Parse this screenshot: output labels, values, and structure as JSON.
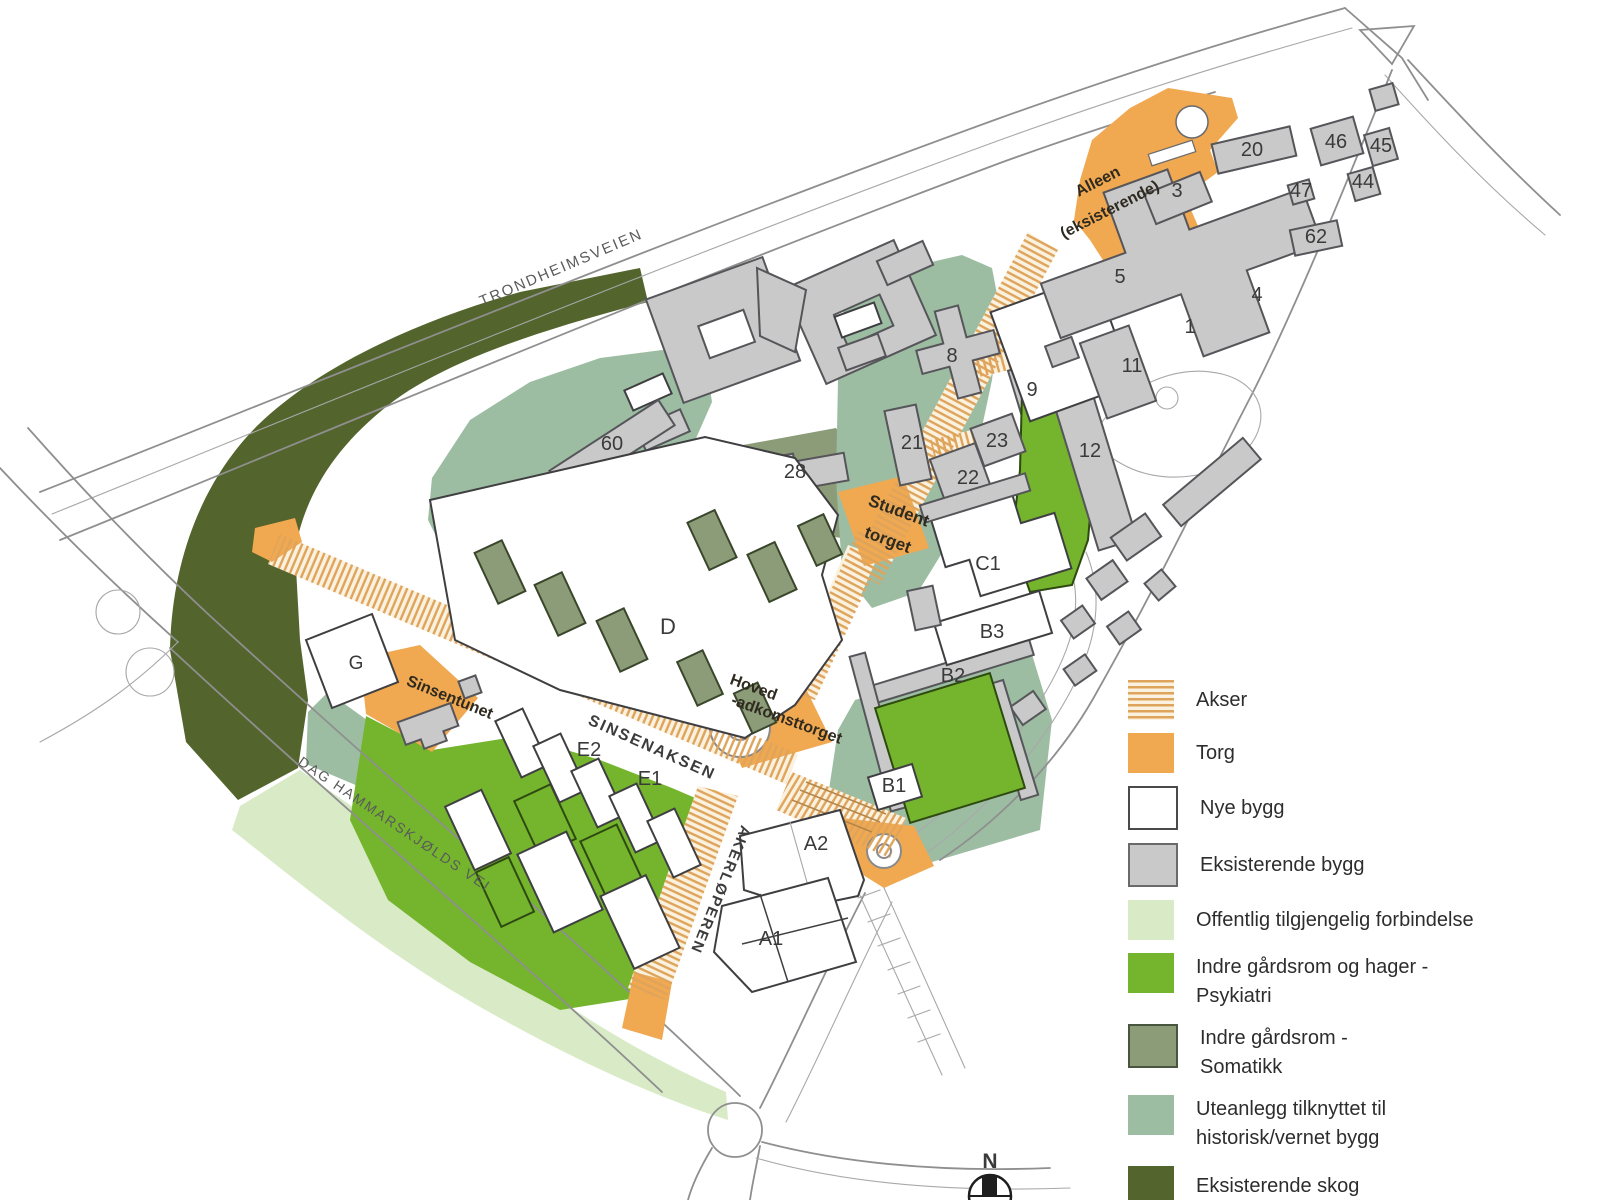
{
  "title": "Site plan - campus development with legend (Norwegian)",
  "colors": {
    "torg": "#F0A851",
    "stripe": "#DFA45B",
    "cream": "#FAF1DF",
    "new_building": "#FFFFFF",
    "existing_building": "#C9C9C9",
    "psykiatri_green": "#74B52D",
    "somatikk_green": "#8C9B78",
    "historic_green": "#9DBDA3",
    "public_green": "#D9EBC6",
    "forest_green": "#53642D",
    "road_gray": "#8F8F8F"
  },
  "map": {
    "north_label": "N",
    "street_labels": [
      {
        "id": "trondheimsveien",
        "text": "TRONDHEIMSVEIEN",
        "x": 563,
        "y": 272,
        "rotate": -23,
        "size": 15,
        "ls": 2,
        "color": "#5a5a5a",
        "weight": "normal"
      },
      {
        "id": "dag-hammarskjolds-vei",
        "text": "DAG HAMMARSKJØLDS VEI",
        "x": 392,
        "y": 828,
        "rotate": 34,
        "size": 14,
        "ls": 2,
        "color": "#5a5a5a",
        "weight": "normal"
      },
      {
        "id": "sinsenaksen",
        "text": "SINSENAKSEN",
        "x": 650,
        "y": 752,
        "rotate": 24,
        "size": 16,
        "ls": 2,
        "color": "#3c3c3c",
        "weight": "bold"
      },
      {
        "id": "akerloperen",
        "text": "AKERLØPEREN",
        "x": 716,
        "y": 888,
        "rotate": 112,
        "size": 15,
        "ls": 2,
        "color": "#3c3c3c",
        "weight": "bold"
      }
    ],
    "area_labels": [
      {
        "id": "studenttorget-1",
        "text": "Student",
        "x": 897,
        "y": 516,
        "rotate": 20,
        "size": 17,
        "color": "#2f2a20",
        "weight": "bold"
      },
      {
        "id": "studenttorget-2",
        "text": "torget",
        "x": 886,
        "y": 545,
        "rotate": 20,
        "size": 17,
        "color": "#2f2a20",
        "weight": "bold"
      },
      {
        "id": "hovedadkomsttorget-1",
        "text": "Hoved",
        "x": 752,
        "y": 692,
        "rotate": 20,
        "size": 16,
        "color": "#2f2a20",
        "weight": "bold"
      },
      {
        "id": "hovedadkomsttorget-2",
        "text": "-adkomsttorget",
        "x": 785,
        "y": 724,
        "rotate": 20,
        "size": 16,
        "color": "#2f2a20",
        "weight": "bold"
      },
      {
        "id": "sinsentunet",
        "text": "Sinsentunet",
        "x": 448,
        "y": 702,
        "rotate": 22,
        "size": 16,
        "color": "#2f2a20",
        "weight": "bold"
      },
      {
        "id": "alleen-1",
        "text": "Alleen",
        "x": 1100,
        "y": 186,
        "rotate": -27,
        "size": 16,
        "color": "#2f2a20",
        "weight": "bold"
      },
      {
        "id": "alleen-2",
        "text": "(eksisterende)",
        "x": 1112,
        "y": 214,
        "rotate": -27,
        "size": 16,
        "color": "#2f2a20",
        "weight": "bold"
      }
    ],
    "building_labels": [
      {
        "id": "b60",
        "text": "60",
        "x": 612,
        "y": 450,
        "size": 20
      },
      {
        "id": "b28",
        "text": "28",
        "x": 795,
        "y": 478,
        "size": 20
      },
      {
        "id": "b8",
        "text": "8",
        "x": 952,
        "y": 362,
        "size": 20
      },
      {
        "id": "b9",
        "text": "9",
        "x": 1032,
        "y": 396,
        "size": 20
      },
      {
        "id": "b21",
        "text": "21",
        "x": 912,
        "y": 449,
        "size": 20
      },
      {
        "id": "b23",
        "text": "23",
        "x": 997,
        "y": 447,
        "size": 20
      },
      {
        "id": "b22",
        "text": "22",
        "x": 968,
        "y": 484,
        "size": 20
      },
      {
        "id": "b12",
        "text": "12",
        "x": 1090,
        "y": 457,
        "size": 20
      },
      {
        "id": "b11",
        "text": "11",
        "x": 1132,
        "y": 372,
        "size": 20
      },
      {
        "id": "b1",
        "text": "1",
        "x": 1190,
        "y": 333,
        "size": 20
      },
      {
        "id": "b5",
        "text": "5",
        "x": 1120,
        "y": 283,
        "size": 20
      },
      {
        "id": "b4",
        "text": "4",
        "x": 1257,
        "y": 301,
        "size": 20
      },
      {
        "id": "b3",
        "text": "3",
        "x": 1177,
        "y": 197,
        "size": 20
      },
      {
        "id": "b20",
        "text": "20",
        "x": 1252,
        "y": 156,
        "size": 20
      },
      {
        "id": "b46",
        "text": "46",
        "x": 1336,
        "y": 148,
        "size": 20
      },
      {
        "id": "b45",
        "text": "45",
        "x": 1381,
        "y": 152,
        "size": 20
      },
      {
        "id": "b44",
        "text": "44",
        "x": 1363,
        "y": 188,
        "size": 20
      },
      {
        "id": "b47",
        "text": "47",
        "x": 1301,
        "y": 197,
        "size": 20
      },
      {
        "id": "b62",
        "text": "62",
        "x": 1316,
        "y": 243,
        "size": 20
      },
      {
        "id": "bC1",
        "text": "C1",
        "x": 988,
        "y": 570,
        "size": 20
      },
      {
        "id": "bB3",
        "text": "B3",
        "x": 992,
        "y": 638,
        "size": 20
      },
      {
        "id": "bB2",
        "text": "B2",
        "x": 953,
        "y": 682,
        "size": 20
      },
      {
        "id": "bB1",
        "text": "B1",
        "x": 894,
        "y": 792,
        "size": 20
      },
      {
        "id": "bA2",
        "text": "A2",
        "x": 816,
        "y": 850,
        "size": 20
      },
      {
        "id": "bA1",
        "text": "A1",
        "x": 771,
        "y": 945,
        "size": 20
      },
      {
        "id": "bD",
        "text": "D",
        "x": 668,
        "y": 634,
        "size": 22
      },
      {
        "id": "bE2",
        "text": "E2",
        "x": 589,
        "y": 756,
        "size": 20
      },
      {
        "id": "bE1",
        "text": "E1",
        "x": 650,
        "y": 785,
        "size": 20
      },
      {
        "id": "bG",
        "text": "G",
        "x": 356,
        "y": 669,
        "size": 19
      }
    ]
  },
  "legend": {
    "items": [
      {
        "id": "akser",
        "label_lines": [
          "Akser"
        ],
        "swatch": {
          "type": "stripes"
        }
      },
      {
        "id": "torg",
        "label_lines": [
          "Torg"
        ],
        "swatch": {
          "type": "solid",
          "color": "#F0A851"
        }
      },
      {
        "id": "nye-bygg",
        "label_lines": [
          "Nye bygg"
        ],
        "swatch": {
          "type": "solid",
          "color": "#FFFFFF",
          "border": "#4a4a4c"
        }
      },
      {
        "id": "eksisterende-bygg",
        "label_lines": [
          "Eksisterende bygg"
        ],
        "swatch": {
          "type": "solid",
          "color": "#C9C9C9",
          "border": "#6a6a6c"
        }
      },
      {
        "id": "offentlig",
        "label_lines": [
          "Offentlig tilgjengelig forbindelse"
        ],
        "swatch": {
          "type": "solid",
          "color": "#D9EBC6"
        }
      },
      {
        "id": "psykiatri",
        "label_lines": [
          "Indre gårdsrom og hager -",
          "Psykiatri"
        ],
        "swatch": {
          "type": "solid",
          "color": "#74B52D"
        }
      },
      {
        "id": "somatikk",
        "label_lines": [
          "Indre gårdsrom -",
          "Somatikk"
        ],
        "swatch": {
          "type": "solid",
          "color": "#8C9B78",
          "border": "#4a5540"
        }
      },
      {
        "id": "uteanlegg",
        "label_lines": [
          "Uteanlegg tilknyttet til",
          "historisk/vernet bygg"
        ],
        "swatch": {
          "type": "solid",
          "color": "#9DBDA3"
        }
      },
      {
        "id": "skog",
        "label_lines": [
          "Eksisterende skog"
        ],
        "swatch": {
          "type": "solid",
          "color": "#53642D"
        }
      }
    ]
  }
}
